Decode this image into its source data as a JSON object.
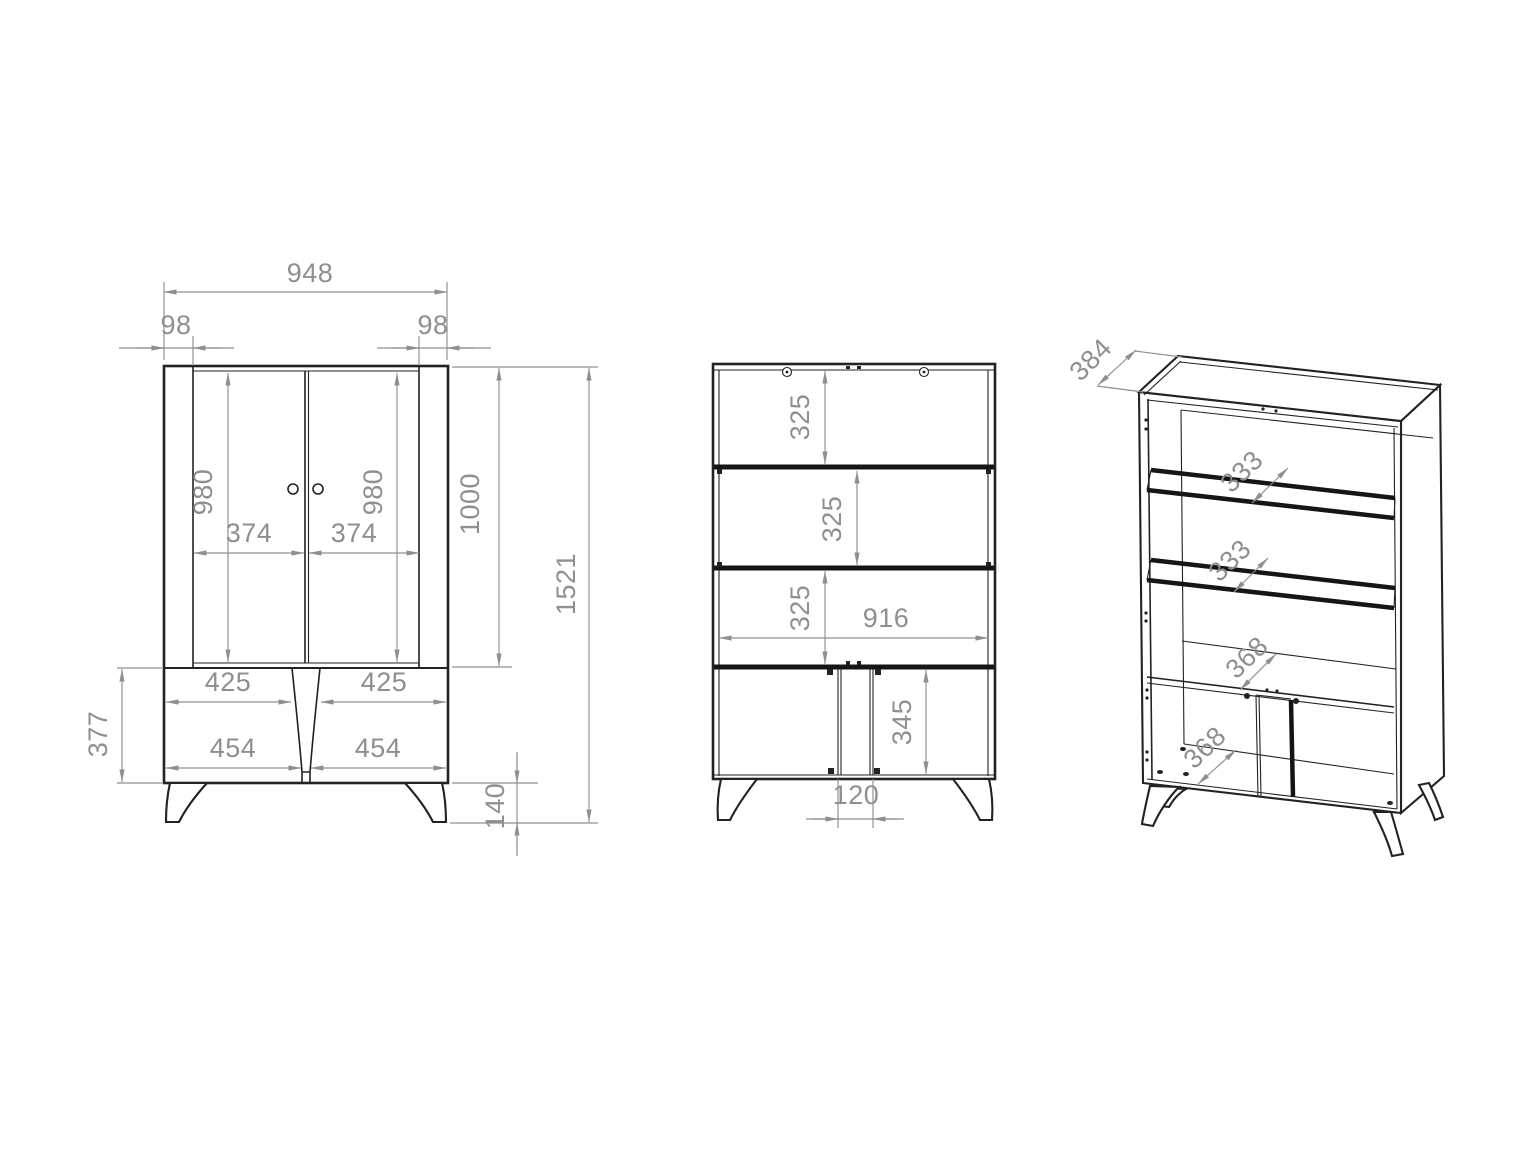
{
  "drawing": {
    "kind": "furniture technical drawing, three orthographic/isometric views of a display cabinet",
    "colors": {
      "background": "#ffffff",
      "outline": "#222222",
      "dimension": "#8f8f8f"
    }
  },
  "views": {
    "front": {
      "label": "front-elevation",
      "dims": {
        "total_width": "948",
        "left_side": "98",
        "right_side": "98",
        "left_door_height": "980",
        "right_door_height": "980",
        "left_door_width": "374",
        "right_door_width": "374",
        "upper_section_height": "1000",
        "total_height": "1521",
        "left_shelf_width": "425",
        "right_shelf_width": "425",
        "left_base_width": "454",
        "right_base_width": "454",
        "base_section_height": "377",
        "leg_height": "140"
      }
    },
    "interior": {
      "label": "interior-elevation",
      "dims": {
        "shelf_gap_top": "325",
        "shelf_gap_middle": "325",
        "shelf_gap_bottom": "325",
        "interior_width": "916",
        "base_interior_height": "345",
        "center_post_width": "120"
      }
    },
    "isometric": {
      "label": "isometric-view",
      "dims": {
        "top_depth": "384",
        "glass_shelf_depth_upper": "333",
        "glass_shelf_depth_lower": "333",
        "middle_shelf_depth": "368",
        "bottom_shelf_depth": "368"
      }
    }
  }
}
